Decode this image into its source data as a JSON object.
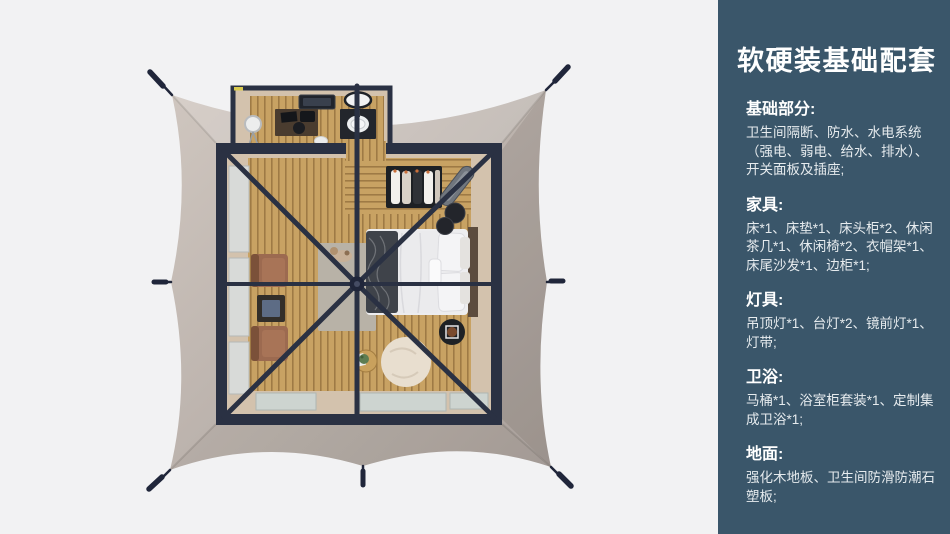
{
  "palette": {
    "page-bg": "#f2f2f3",
    "panel-bg": "#3a566a",
    "panel-title": "#ffffff",
    "panel-body": "#e6ebee",
    "frame": "#2a3143",
    "canopy-light": "#cfc6bf",
    "canopy-dark": "#a9a09b",
    "wood": "#c8a263",
    "wall": "#d3c2ad",
    "glass": "#cdd4d0",
    "rug": "#b8b2a7",
    "bedding": "#ededef",
    "throw": "#3f434a",
    "leather": "#9c6a50",
    "dark-item": "#1d2024",
    "beanbag": "#e8decf"
  },
  "panel": {
    "title": "软硬装基础配套",
    "sections": [
      {
        "heading": "基础部分:",
        "body": "卫生间隔断、防水、水电系统\n（强电、弱电、给水、排水）、\n开关面板及插座;"
      },
      {
        "heading": "家具:",
        "body": "床*1、床垫*1、床头柜*2、休闲\n茶几*1、休闲椅*2、衣帽架*1、\n床尾沙发*1、边柜*1;"
      },
      {
        "heading": "灯具:",
        "body": "吊顶灯*1、台灯*2、镜前灯*1、\n灯带;"
      },
      {
        "heading": "卫浴:",
        "body": "马桶*1、浴室柜套装*1、定制集\n成卫浴*1;"
      },
      {
        "heading": "地面:",
        "body": "强化木地板、卫生间防滑防潮石\n塑板;"
      }
    ]
  }
}
